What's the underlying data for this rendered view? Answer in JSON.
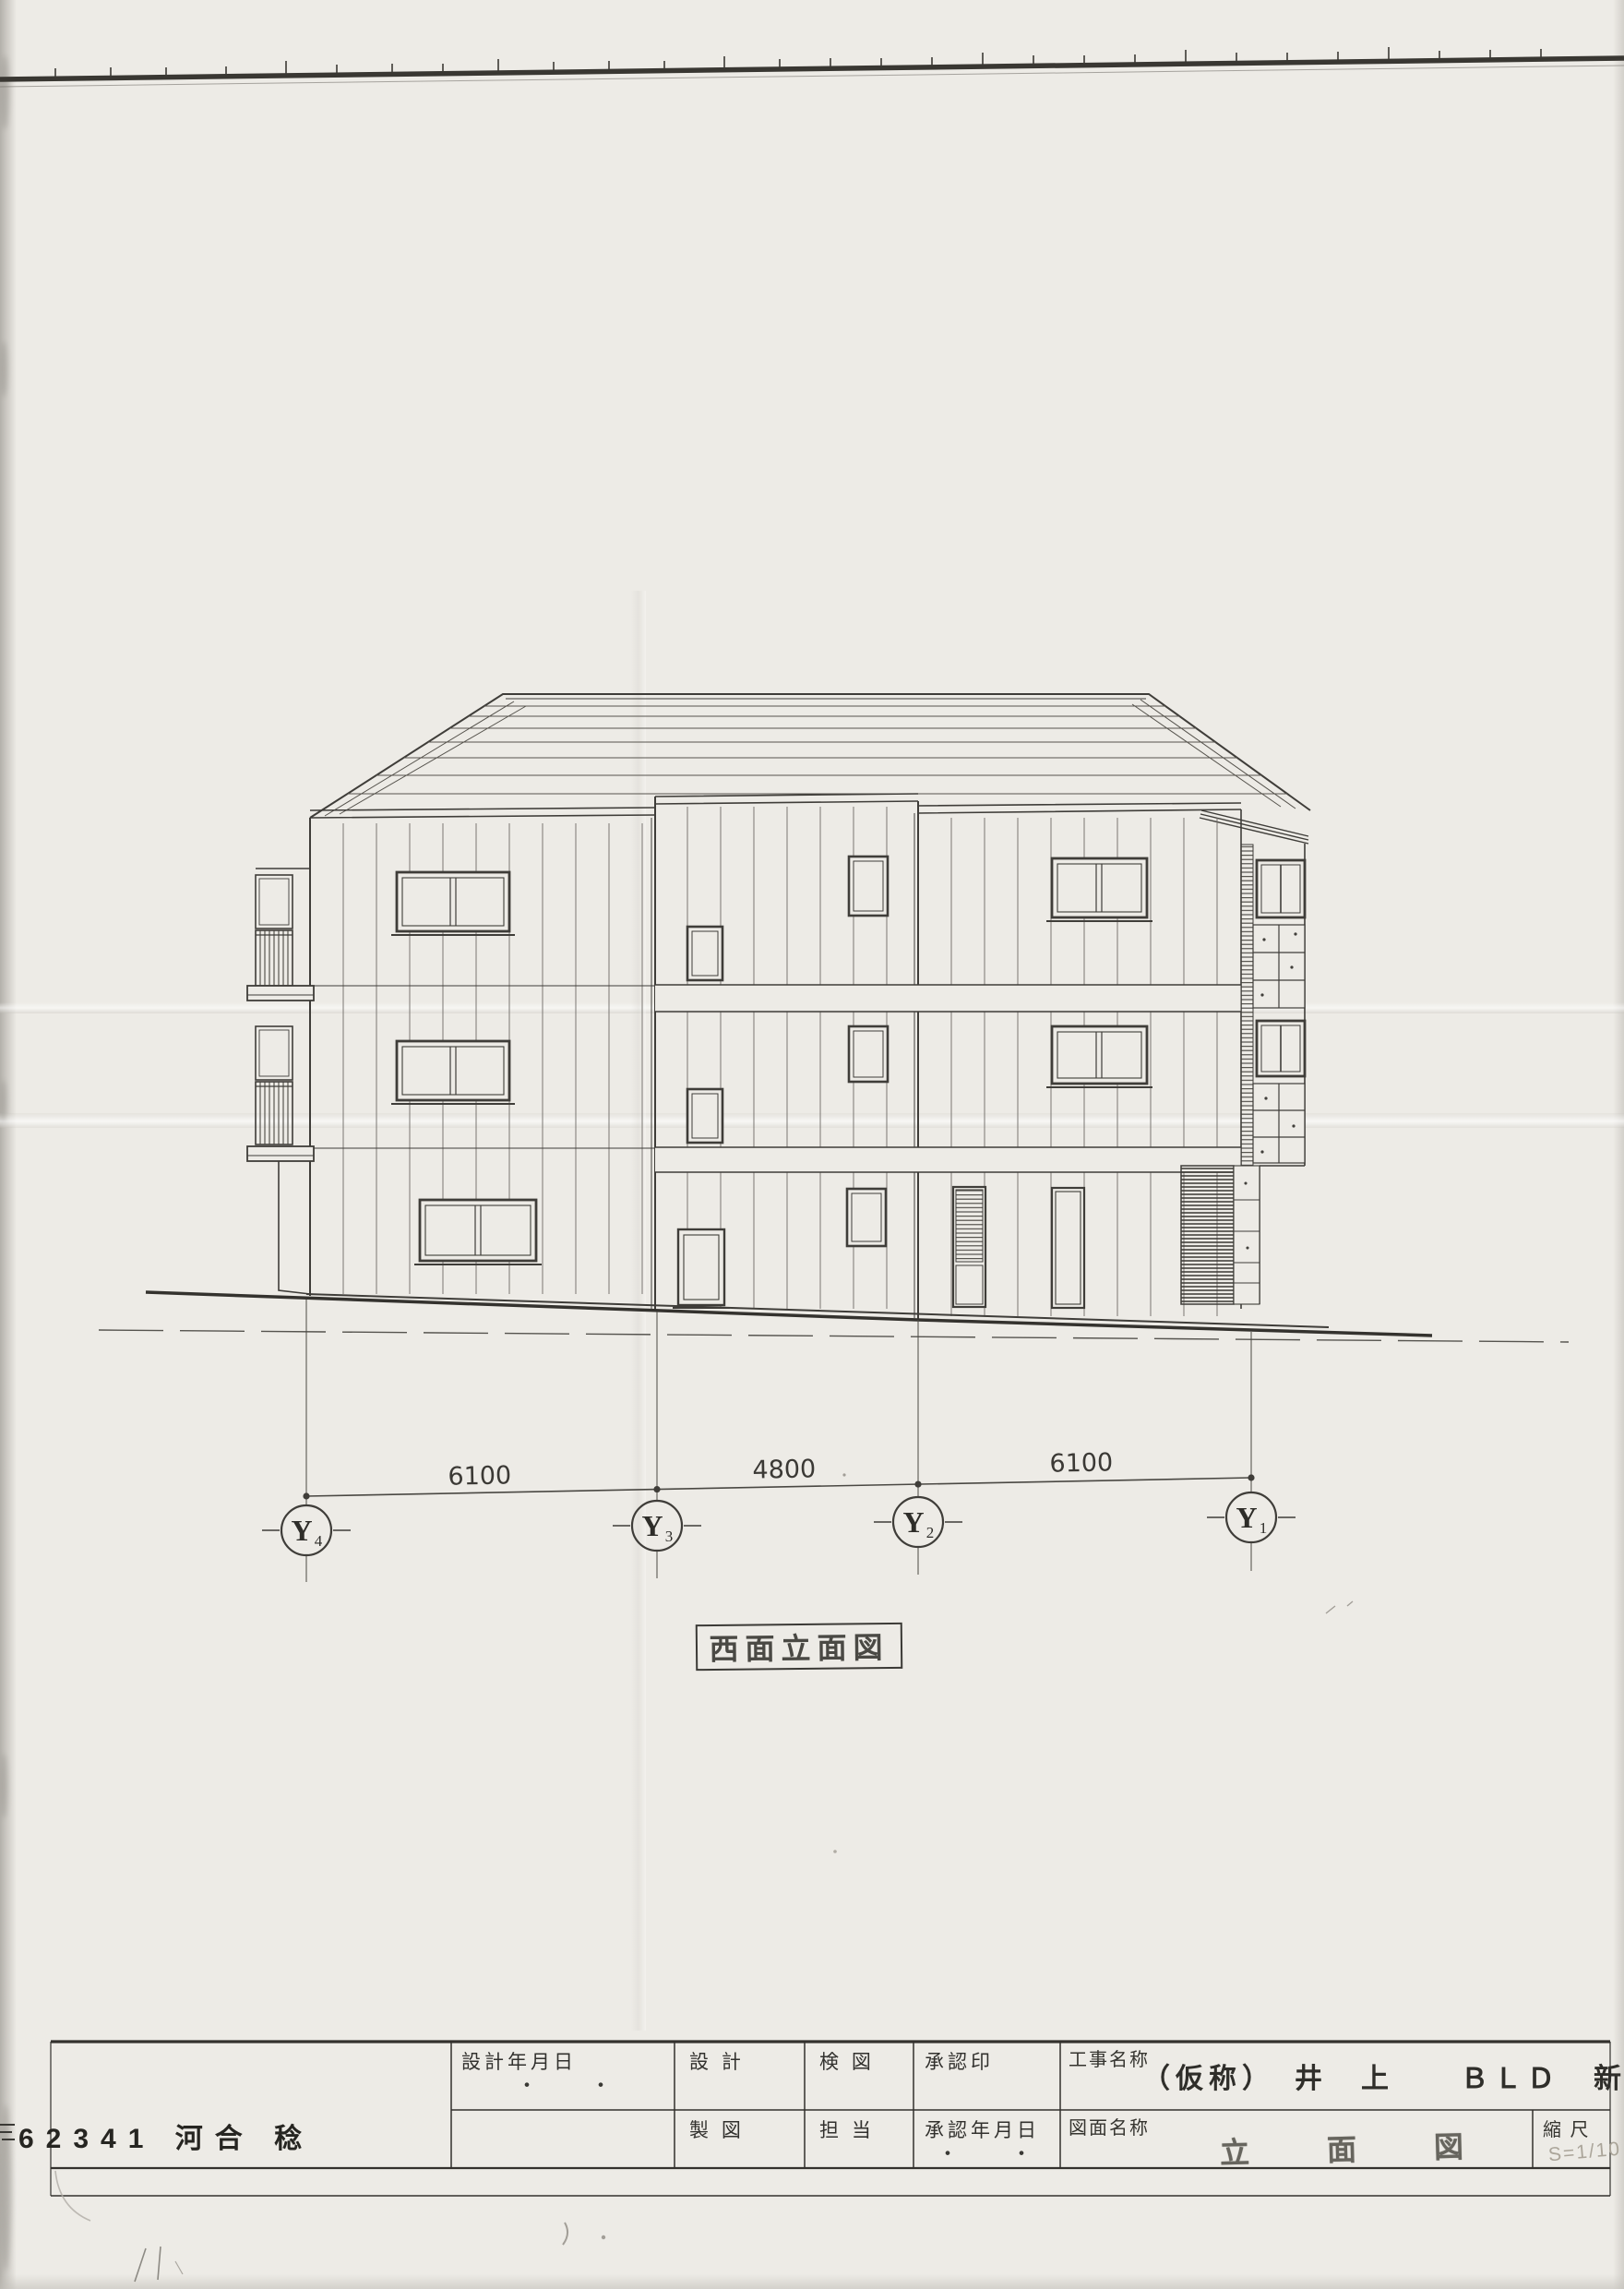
{
  "sheet": {
    "elevation_label": "西面立面図",
    "corner_text": "62341 河合 稔",
    "paper_color": "#edebe6",
    "ink_color": "#3f3d39"
  },
  "dimensions": {
    "segments": [
      "6100",
      "4800",
      "6100"
    ]
  },
  "grid": {
    "items": [
      {
        "label": "Y",
        "sub": "4"
      },
      {
        "label": "Y",
        "sub": "3"
      },
      {
        "label": "Y",
        "sub": "2"
      },
      {
        "label": "Y",
        "sub": "1"
      }
    ]
  },
  "title_block": {
    "design_date_label": "設計年月日",
    "design_date_dots": "・　・",
    "design_label": "設 計",
    "check_label": "検 図",
    "approval_seal_label": "承認印",
    "project_name_label": "工事名称",
    "project_name_value": "（仮称）　井　上　　ＢＬＤ　新築工事",
    "draft_label": "製 図",
    "charge_label": "担 当",
    "approval_date_label": "承認年月日",
    "approval_date_dots": "・　・",
    "drawing_name_label": "図面名称",
    "drawing_name_value": "立　面　図",
    "scale_label": "縮 尺",
    "scale_value": "S=1/10"
  }
}
